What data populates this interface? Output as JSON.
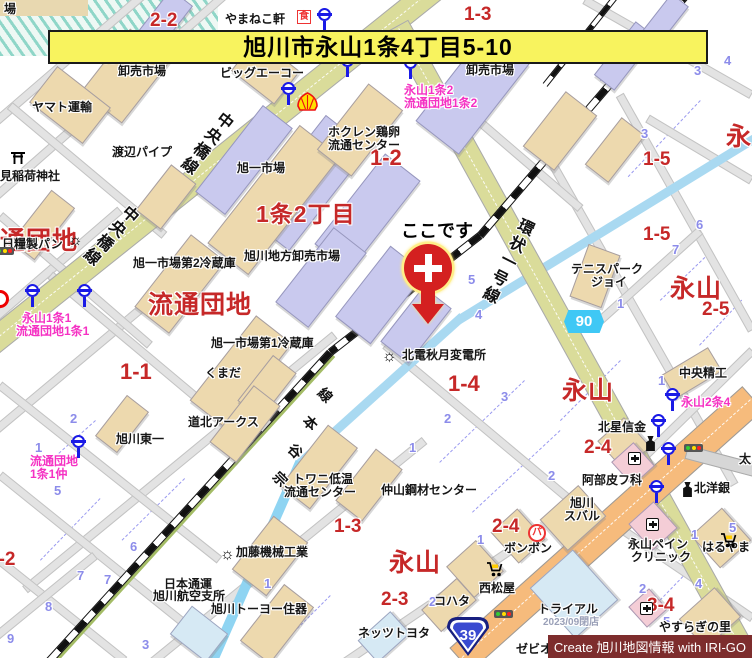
{
  "banner": {
    "text": "旭川市永山1条4丁目5-10"
  },
  "marker": {
    "label": "ここです",
    "x": 404,
    "y": 244
  },
  "credit": {
    "text": "Create 旭川地図情報 with IRI-GO"
  },
  "colors": {
    "banner_bg": "#f8f35e",
    "area_red": "#c62828",
    "busstop_pink": "#f531c3",
    "lot_blue": "#8c8cea",
    "road_olive": "#dadc9a",
    "road_orange": "#f6bb7c",
    "river_blue": "#a9d9f1",
    "pref_badge_blue": "#3fc8f5",
    "national_badge_blue": "#3a4ad0",
    "credit_bg": "#7d2d2d"
  },
  "badges": [
    {
      "kind": "prefectural",
      "number": "90",
      "x": 564,
      "y": 310
    },
    {
      "kind": "national",
      "number": "39",
      "x": 444,
      "y": 614
    }
  ],
  "labels": [
    {
      "t": "場",
      "x": 4,
      "y": 3,
      "c": "poi"
    },
    {
      "t": "やまねこ軒",
      "x": 225,
      "y": 13,
      "c": "poi"
    },
    {
      "t": "1-3",
      "x": 464,
      "y": 5,
      "c": "blk"
    },
    {
      "t": "2-2",
      "x": 150,
      "y": 11,
      "c": "blk"
    },
    {
      "t": "旭川生花地方",
      "x": 105,
      "y": 52,
      "c": "poi"
    },
    {
      "t": "卸売市場",
      "x": 118,
      "y": 65,
      "c": "poi"
    },
    {
      "t": "ビッグエーコー",
      "x": 220,
      "y": 67,
      "c": "poi"
    },
    {
      "t": "卸売市場",
      "x": 466,
      "y": 64,
      "c": "poi"
    },
    {
      "t": "永山1条2",
      "x": 404,
      "y": 84,
      "c": "bus"
    },
    {
      "t": "流通団地1条2",
      "x": 404,
      "y": 97,
      "c": "bus"
    },
    {
      "t": "ヤマト運輸",
      "x": 32,
      "y": 101,
      "c": "poi"
    },
    {
      "t": "渡辺パイプ",
      "x": 112,
      "y": 146,
      "c": "poi"
    },
    {
      "t": "見稲荷神社",
      "x": 0,
      "y": 170,
      "c": "poi"
    },
    {
      "t": "日糧製パン",
      "x": 2,
      "y": 238,
      "c": "poi"
    },
    {
      "t": "ホクレン鶏卵",
      "x": 328,
      "y": 126,
      "c": "poi"
    },
    {
      "t": "流通センター",
      "x": 328,
      "y": 139,
      "c": "poi"
    },
    {
      "t": "旭一市場",
      "x": 237,
      "y": 162,
      "c": "poi"
    },
    {
      "t": "1-2",
      "x": 370,
      "y": 146,
      "c": "blk",
      "fs": 22
    },
    {
      "t": "1条2丁目",
      "x": 256,
      "y": 202,
      "c": "area",
      "fs": 23
    },
    {
      "t": "旭川地方卸売市場",
      "x": 244,
      "y": 250,
      "c": "poi"
    },
    {
      "t": "旭一市場第2冷蔵庫",
      "x": 133,
      "y": 257,
      "c": "poi"
    },
    {
      "t": "流通団地",
      "x": 148,
      "y": 292,
      "c": "area"
    },
    {
      "t": "流通団地",
      "x": -26,
      "y": 228,
      "c": "area"
    },
    {
      "t": "永山1条1",
      "x": 22,
      "y": 312,
      "c": "bus"
    },
    {
      "t": "流通団地1条1",
      "x": 16,
      "y": 325,
      "c": "bus"
    },
    {
      "t": "1-1",
      "x": 120,
      "y": 360,
      "c": "blk",
      "fs": 22
    },
    {
      "t": "1-5",
      "x": 643,
      "y": 150,
      "c": "blk"
    },
    {
      "t": "1-5",
      "x": 643,
      "y": 225,
      "c": "blk"
    },
    {
      "t": "永",
      "x": 726,
      "y": 124,
      "c": "area"
    },
    {
      "t": "テニスパーク",
      "x": 571,
      "y": 263,
      "c": "poi"
    },
    {
      "t": "ジョイ",
      "x": 591,
      "y": 276,
      "c": "poi"
    },
    {
      "t": "永山",
      "x": 670,
      "y": 276,
      "c": "area"
    },
    {
      "t": "2-5",
      "x": 702,
      "y": 300,
      "c": "blk"
    },
    {
      "t": "旭一市場第1冷蔵庫",
      "x": 211,
      "y": 337,
      "c": "poi"
    },
    {
      "t": "くまだ",
      "x": 205,
      "y": 367,
      "c": "poi"
    },
    {
      "t": "北電秋月変電所",
      "x": 402,
      "y": 349,
      "c": "poi"
    },
    {
      "t": "1-4",
      "x": 448,
      "y": 372,
      "c": "blk",
      "fs": 22
    },
    {
      "t": "永山",
      "x": 562,
      "y": 378,
      "c": "area"
    },
    {
      "t": "中央精工",
      "x": 679,
      "y": 367,
      "c": "poi"
    },
    {
      "t": "永山2条4",
      "x": 681,
      "y": 396,
      "c": "bus"
    },
    {
      "t": "道北アークス",
      "x": 188,
      "y": 416,
      "c": "poi"
    },
    {
      "t": "旭川東一",
      "x": 116,
      "y": 433,
      "c": "poi"
    },
    {
      "t": "流通団地",
      "x": 30,
      "y": 455,
      "c": "bus"
    },
    {
      "t": "1条1仲",
      "x": 30,
      "y": 468,
      "c": "bus"
    },
    {
      "t": "北星信金",
      "x": 598,
      "y": 421,
      "c": "poi"
    },
    {
      "t": "2-4",
      "x": 584,
      "y": 438,
      "c": "blk"
    },
    {
      "t": "阿部皮フ科",
      "x": 582,
      "y": 474,
      "c": "poi"
    },
    {
      "t": "北洋銀",
      "x": 694,
      "y": 482,
      "c": "poi"
    },
    {
      "t": "太",
      "x": 739,
      "y": 453,
      "c": "poi"
    },
    {
      "t": "トワニ低温",
      "x": 293,
      "y": 473,
      "c": "poi"
    },
    {
      "t": "流通センター",
      "x": 284,
      "y": 486,
      "c": "poi"
    },
    {
      "t": "仲山鋼材センター",
      "x": 381,
      "y": 484,
      "c": "poi"
    },
    {
      "t": "旭川",
      "x": 570,
      "y": 497,
      "c": "poi"
    },
    {
      "t": "スバル",
      "x": 564,
      "y": 510,
      "c": "poi"
    },
    {
      "t": "2-4",
      "x": 492,
      "y": 517,
      "c": "blk"
    },
    {
      "t": "ボンボン",
      "x": 504,
      "y": 542,
      "c": "poi"
    },
    {
      "t": "永山ペイン",
      "x": 628,
      "y": 538,
      "c": "poi"
    },
    {
      "t": "クリニック",
      "x": 631,
      "y": 551,
      "c": "poi"
    },
    {
      "t": "はるやま",
      "x": 702,
      "y": 541,
      "c": "poi"
    },
    {
      "t": "永山",
      "x": 389,
      "y": 550,
      "c": "area"
    },
    {
      "t": "加藤機械工業",
      "x": 236,
      "y": 546,
      "c": "poi"
    },
    {
      "t": "2-3",
      "x": 381,
      "y": 590,
      "c": "blk"
    },
    {
      "t": "西松屋",
      "x": 479,
      "y": 582,
      "c": "poi"
    },
    {
      "t": "コハタ",
      "x": 434,
      "y": 595,
      "c": "poi"
    },
    {
      "t": "トライアル",
      "x": 538,
      "y": 603,
      "c": "poi"
    },
    {
      "t": "2023/09閉店",
      "x": 543,
      "y": 618,
      "c": "closed"
    },
    {
      "t": "3-4",
      "x": 647,
      "y": 596,
      "c": "blk"
    },
    {
      "t": "やすらぎの里",
      "x": 659,
      "y": 621,
      "c": "poi"
    },
    {
      "t": "日本通運",
      "x": 164,
      "y": 578,
      "c": "poi"
    },
    {
      "t": "旭川航空支所",
      "x": 153,
      "y": 590,
      "c": "poi"
    },
    {
      "t": "旭川トーヨー住器",
      "x": 211,
      "y": 603,
      "c": "poi"
    },
    {
      "t": "ネッツトヨタ",
      "x": 358,
      "y": 627,
      "c": "poi"
    },
    {
      "t": "ゼビオ",
      "x": 516,
      "y": 643,
      "c": "poi"
    },
    {
      "t": "3-2",
      "x": -12,
      "y": 550,
      "c": "blk"
    },
    {
      "t": "1-3",
      "x": 334,
      "y": 517,
      "c": "blk"
    },
    {
      "t": "中央橋線",
      "x": 196,
      "y": 104,
      "c": "rname",
      "r": 38
    },
    {
      "t": "中央橋線",
      "x": 100,
      "y": 196,
      "c": "rname",
      "r": 42
    },
    {
      "t": "環状一号線",
      "x": 497,
      "y": 213,
      "c": "rname",
      "r": 27
    },
    {
      "t": "線",
      "x": 318,
      "y": 388,
      "c": "rail-ch",
      "r": 45
    },
    {
      "t": "本",
      "x": 303,
      "y": 416,
      "c": "rail-ch",
      "r": 45
    },
    {
      "t": "谷",
      "x": 288,
      "y": 444,
      "c": "rail-ch",
      "r": 45
    },
    {
      "t": "宗",
      "x": 273,
      "y": 472,
      "c": "rail-ch",
      "r": 45
    },
    {
      "t": "4",
      "x": 724,
      "y": 54,
      "c": "lot"
    },
    {
      "t": "3",
      "x": 694,
      "y": 64,
      "c": "lot"
    },
    {
      "t": "3",
      "x": 641,
      "y": 127,
      "c": "lot"
    },
    {
      "t": "6",
      "x": 696,
      "y": 218,
      "c": "lot"
    },
    {
      "t": "7",
      "x": 672,
      "y": 243,
      "c": "lot"
    },
    {
      "t": "5",
      "x": 468,
      "y": 273,
      "c": "lot"
    },
    {
      "t": "4",
      "x": 475,
      "y": 308,
      "c": "lot"
    },
    {
      "t": "1",
      "x": 617,
      "y": 297,
      "c": "lot"
    },
    {
      "t": "3",
      "x": 501,
      "y": 390,
      "c": "lot"
    },
    {
      "t": "2",
      "x": 444,
      "y": 412,
      "c": "lot"
    },
    {
      "t": "1",
      "x": 409,
      "y": 441,
      "c": "lot"
    },
    {
      "t": "2",
      "x": 548,
      "y": 469,
      "c": "lot"
    },
    {
      "t": "1",
      "x": 658,
      "y": 374,
      "c": "lot"
    },
    {
      "t": "1",
      "x": 477,
      "y": 533,
      "c": "lot"
    },
    {
      "t": "2",
      "x": 429,
      "y": 595,
      "c": "lot"
    },
    {
      "t": "1",
      "x": 264,
      "y": 577,
      "c": "lot"
    },
    {
      "t": "6",
      "x": 130,
      "y": 540,
      "c": "lot"
    },
    {
      "t": "7",
      "x": 77,
      "y": 569,
      "c": "lot"
    },
    {
      "t": "7",
      "x": 104,
      "y": 573,
      "c": "lot"
    },
    {
      "t": "8",
      "x": 45,
      "y": 600,
      "c": "lot"
    },
    {
      "t": "9",
      "x": 7,
      "y": 632,
      "c": "lot"
    },
    {
      "t": "3",
      "x": 142,
      "y": 638,
      "c": "lot"
    },
    {
      "t": "5",
      "x": 54,
      "y": 484,
      "c": "lot"
    },
    {
      "t": "2",
      "x": 70,
      "y": 412,
      "c": "lot"
    },
    {
      "t": "1",
      "x": 35,
      "y": 441,
      "c": "lot"
    },
    {
      "t": "5",
      "x": 555,
      "y": 643,
      "c": "lot"
    },
    {
      "t": "5",
      "x": 729,
      "y": 521,
      "c": "lot"
    },
    {
      "t": "4",
      "x": 695,
      "y": 577,
      "c": "lot"
    },
    {
      "t": "2",
      "x": 639,
      "y": 582,
      "c": "lot"
    },
    {
      "t": "5",
      "x": 663,
      "y": 615,
      "c": "lot"
    },
    {
      "t": "1",
      "x": 691,
      "y": 528,
      "c": "lot"
    }
  ],
  "icons": [
    {
      "k": "restaurant",
      "x": 297,
      "y": 10,
      "t": "食"
    },
    {
      "k": "bus",
      "x": 318,
      "y": 8
    },
    {
      "k": "bus",
      "x": 282,
      "y": 82
    },
    {
      "k": "bus",
      "x": 341,
      "y": 54
    },
    {
      "k": "bus",
      "x": 404,
      "y": 56
    },
    {
      "k": "shell",
      "x": 296,
      "y": 92
    },
    {
      "k": "torii",
      "x": 10,
      "y": 150
    },
    {
      "k": "factory",
      "x": 68,
      "y": 233
    },
    {
      "k": "bus",
      "x": 26,
      "y": 284
    },
    {
      "k": "bus",
      "x": 78,
      "y": 284
    },
    {
      "k": "traffic",
      "x": -5,
      "y": 247
    },
    {
      "k": "redcircle",
      "x": -9,
      "y": 290
    },
    {
      "k": "bus",
      "x": 72,
      "y": 435
    },
    {
      "k": "factory",
      "x": 382,
      "y": 349
    },
    {
      "k": "factory",
      "x": 220,
      "y": 547
    },
    {
      "k": "traffic",
      "x": 684,
      "y": 444
    },
    {
      "k": "traffic",
      "x": 494,
      "y": 610
    },
    {
      "k": "bus",
      "x": 652,
      "y": 414
    },
    {
      "k": "bus",
      "x": 662,
      "y": 442
    },
    {
      "k": "bus",
      "x": 650,
      "y": 480
    },
    {
      "k": "bus",
      "x": 666,
      "y": 388
    },
    {
      "k": "bank",
      "x": 645,
      "y": 436
    },
    {
      "k": "bank",
      "x": 682,
      "y": 482
    },
    {
      "k": "hospital",
      "x": 628,
      "y": 452
    },
    {
      "k": "hospital",
      "x": 646,
      "y": 518
    },
    {
      "k": "hospital",
      "x": 640,
      "y": 602
    },
    {
      "k": "parking",
      "x": 528,
      "y": 524,
      "t": "パ"
    },
    {
      "k": "cart",
      "x": 486,
      "y": 561
    },
    {
      "k": "cart",
      "x": 720,
      "y": 532
    }
  ]
}
